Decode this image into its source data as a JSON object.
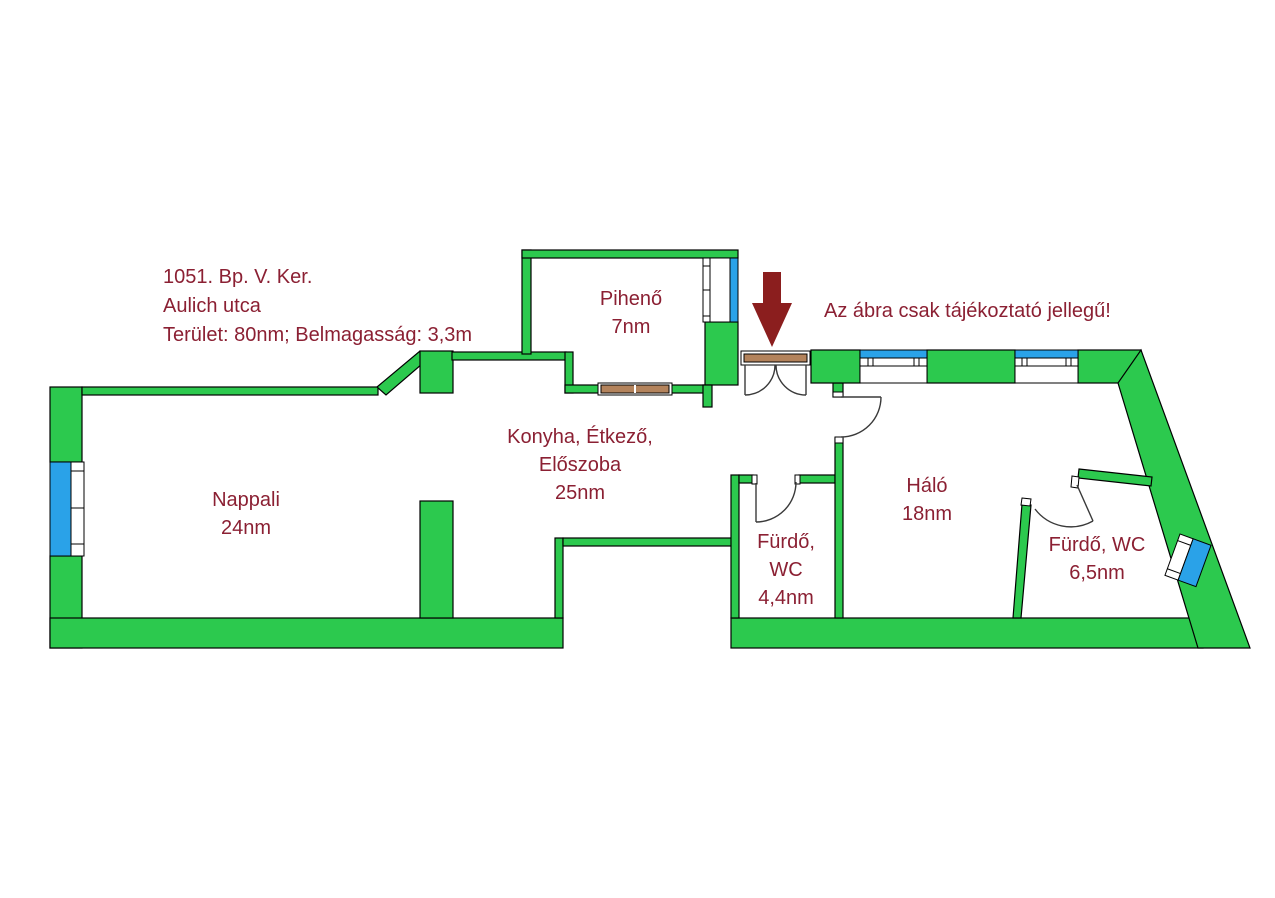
{
  "colors": {
    "wall": "#2cc94e",
    "window_blue": "#2aa2e8",
    "door_brown": "#b3835c",
    "arrow_red": "#8b1e1e",
    "text": "#8b2033"
  },
  "info": {
    "line1": "1051. Bp. V. Ker.",
    "line2": "Aulich utca",
    "line3": "Terület: 80nm; Belmagasság: 3,3m"
  },
  "disclaimer": "Az ábra csak tájékoztató jellegű!",
  "rooms": {
    "piheno": {
      "name": "Pihenő",
      "area": "7nm"
    },
    "nappali": {
      "name": "Nappali",
      "area": "24nm"
    },
    "konyha": {
      "line1": "Konyha, Étkező,",
      "line2": "Előszoba",
      "area": "25nm"
    },
    "furdo_wc_small": {
      "line1": "Fürdő,",
      "line2": "WC",
      "area": "4,4nm"
    },
    "halo": {
      "name": "Háló",
      "area": "18nm"
    },
    "furdo_wc_large": {
      "name": "Fürdő, WC",
      "area": "6,5nm"
    }
  }
}
